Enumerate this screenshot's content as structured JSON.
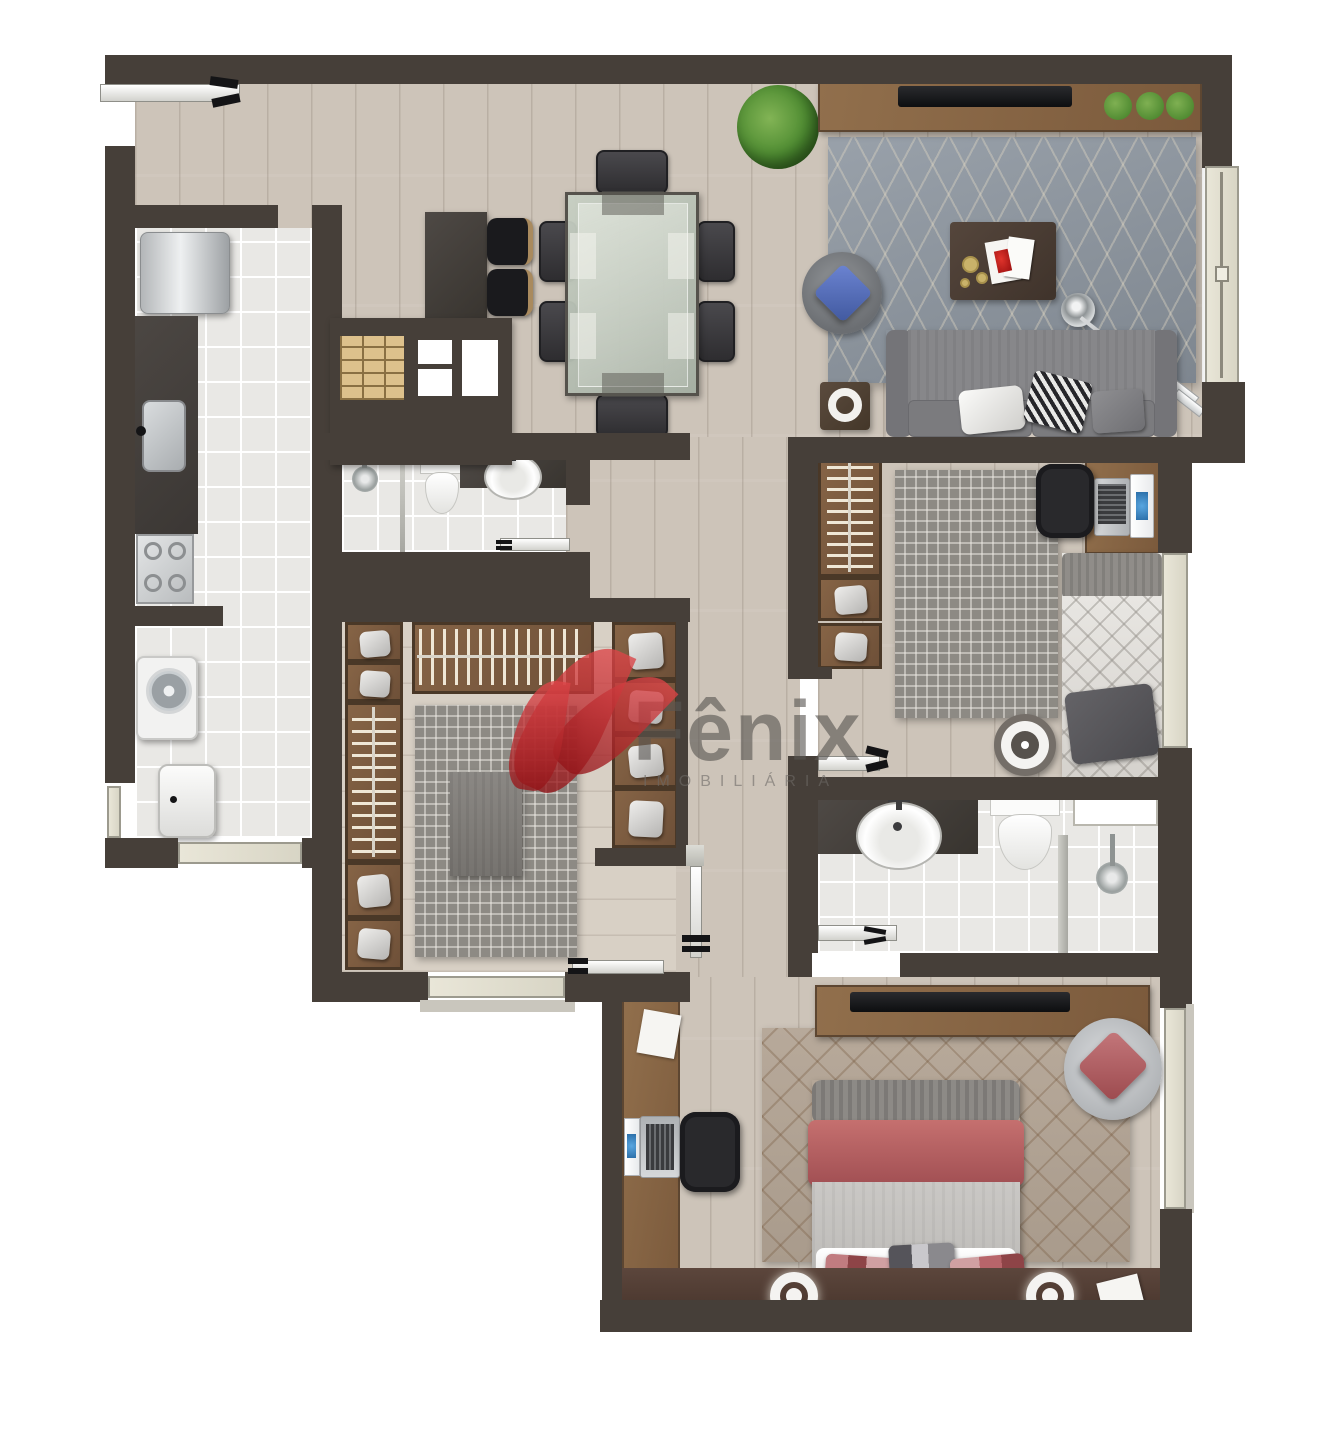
{
  "watermark": {
    "title": "Fênix",
    "subtitle": "IMOBILIÁRIA",
    "logo_icon": "phoenix-leaf-logo"
  },
  "palette": {
    "wall": "#463f39",
    "woodFloor": "#cdc4b9",
    "closetFloor": "#d8d0c5",
    "tile": "#e9e8e5",
    "grout": "#ffffff",
    "counter": "#45403c",
    "furnitureWood": "#856344",
    "wardrobeWood": "#7d5c40",
    "wardrobeFrame": "#4a3827",
    "rugLiving": "#8e959d",
    "rugMaze": "#8d8a84",
    "rugMaster": "#b2a496",
    "sofa": "#7e7e81",
    "bedRose": "#b8656a",
    "pillowBlue": "#5671c4",
    "plant": "#4c8a30",
    "logoRed": "#c22b31",
    "metal": "#c7c9cb",
    "tv": "#121316",
    "glass": "#e4e1d2"
  },
  "furniture_icons": [
    "entry-door-icon",
    "refrigerator-icon",
    "kitchen-sink-icon",
    "stove-icon",
    "washing-machine-icon",
    "laundry-tank-icon",
    "bar-counter-icon",
    "bar-stool-icon",
    "dining-table-icon",
    "dining-chair-icon",
    "plant-icon",
    "tv-console-icon",
    "tv-icon",
    "area-rug-icon",
    "sofa-icon",
    "armchair-icon",
    "coffee-table-icon",
    "arc-floor-lamp-icon",
    "side-table-icon",
    "shower-head-icon",
    "toilet-icon",
    "bathroom-sink-icon",
    "vanity-counter-icon",
    "glass-partition-icon",
    "wardrobe-hanging-rod-icon",
    "wardrobe-shelf-icon",
    "folded-towel-icon",
    "ottoman-icon",
    "desk-icon",
    "laptop-icon",
    "office-chair-icon",
    "single-bed-icon",
    "double-bed-icon",
    "pillow-icon",
    "round-tray-icon",
    "wall-sconce-icon",
    "window-icon",
    "door-leaf-icon",
    "paper-sheet-icon",
    "headboard-panel-icon"
  ]
}
